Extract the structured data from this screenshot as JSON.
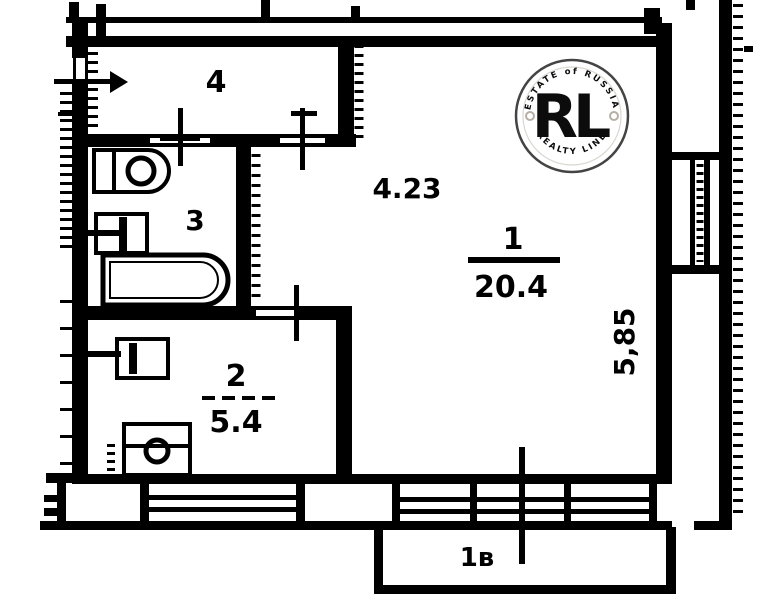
{
  "plan": {
    "rooms": [
      {
        "number": "1",
        "area": "20.4"
      },
      {
        "number": "2",
        "area": "5.4"
      },
      {
        "number": "3"
      },
      {
        "number": "4"
      }
    ],
    "dimensions": {
      "width": "4.23",
      "height": "5,85"
    },
    "balcony": {
      "label": "1в"
    }
  },
  "watermark": {
    "monogram": "RL",
    "arc_top": "ESTATE of RUSSIA",
    "arc_bottom": "REALTY LINE",
    "gold_color": "#c09a33",
    "gray_color": "#b3aba1"
  },
  "colors": {
    "ink": "#000000",
    "background": "#ffffff"
  }
}
